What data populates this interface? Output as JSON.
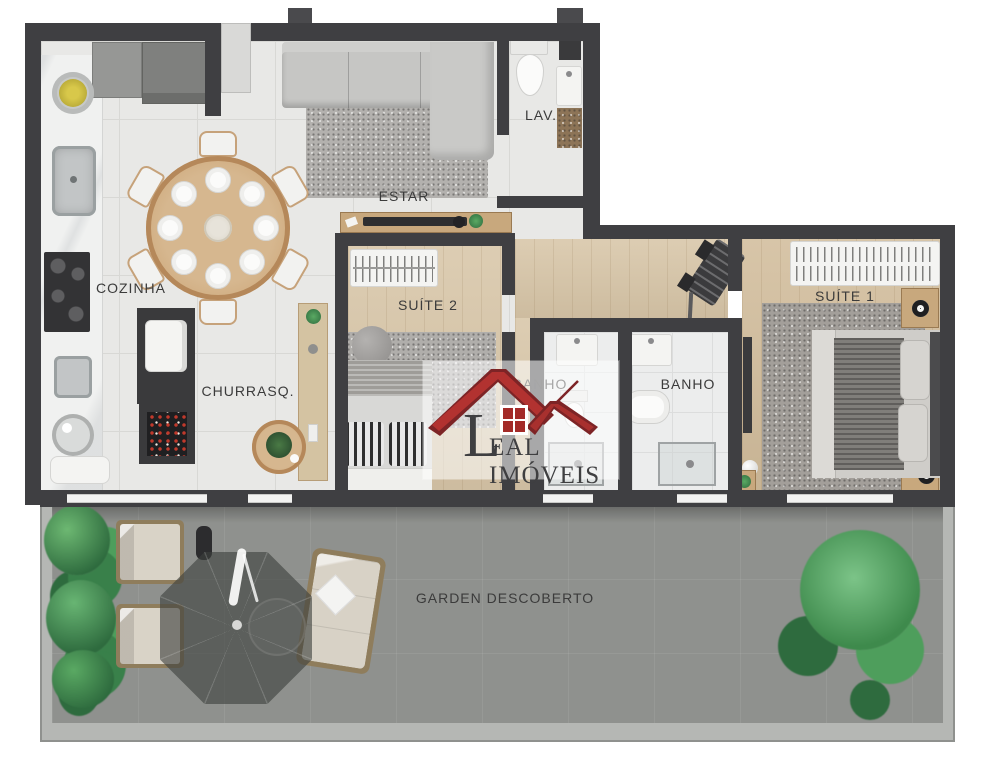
{
  "rooms": {
    "cozinha": {
      "label": "COZINHA"
    },
    "estar": {
      "label": "ESTAR"
    },
    "lav": {
      "label": "LAV."
    },
    "churrasq": {
      "label": "CHURRASQ."
    },
    "suite2": {
      "label": "SUÍTE 2"
    },
    "banho_suite2": {
      "label": "BANHO"
    },
    "banho_suite1": {
      "label": "BANHO"
    },
    "suite1": {
      "label": "SUÍTE 1"
    },
    "garden": {
      "label": "GARDEN DESCOBERTO"
    }
  },
  "watermark": {
    "brand": "LEAL IMÓVEIS",
    "brand_initial": "L",
    "brand_rest": "EAL IMÓVEIS",
    "logo_icon": "double-roof-house-icon",
    "colors": {
      "roof_red": "#b23230",
      "roof_dark_red": "#7d2426",
      "window_red": "#a32a28",
      "text": "#3f3f41",
      "panel_bg": "rgba(255,255,255,0.55)"
    }
  },
  "palette": {
    "wall": "#3f3f42",
    "tile_floor": "#e8e8e6",
    "wood_floor": "#d8c6a8",
    "marble": "#f0f1f0",
    "garden_floor": "#8f918e",
    "garden_curb": "#b5b7b4",
    "plant_green": "#3e8a4c",
    "background": "#ffffff"
  }
}
